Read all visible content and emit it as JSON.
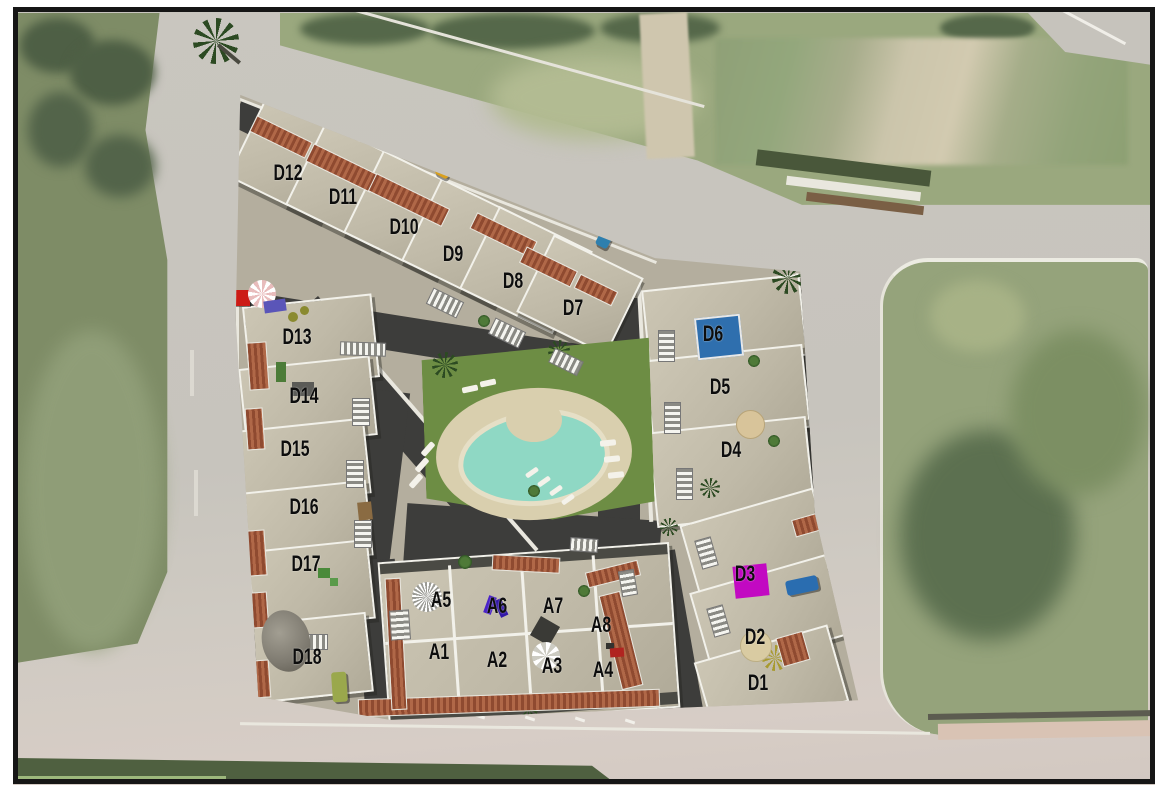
{
  "meta": {
    "title": "aerial-residential-site-plan"
  },
  "units": [
    {
      "id": "D1",
      "x": 758,
      "y": 683
    },
    {
      "id": "D2",
      "x": 755,
      "y": 637
    },
    {
      "id": "D3",
      "x": 745,
      "y": 574
    },
    {
      "id": "D4",
      "x": 731,
      "y": 450
    },
    {
      "id": "D5",
      "x": 720,
      "y": 387
    },
    {
      "id": "D6",
      "x": 713,
      "y": 334
    },
    {
      "id": "D7",
      "x": 573,
      "y": 308
    },
    {
      "id": "D8",
      "x": 513,
      "y": 281
    },
    {
      "id": "D9",
      "x": 453,
      "y": 254
    },
    {
      "id": "D10",
      "x": 404,
      "y": 227
    },
    {
      "id": "D11",
      "x": 343,
      "y": 197
    },
    {
      "id": "D12",
      "x": 288,
      "y": 173
    },
    {
      "id": "D13",
      "x": 297,
      "y": 337
    },
    {
      "id": "D14",
      "x": 304,
      "y": 396
    },
    {
      "id": "D15",
      "x": 295,
      "y": 449
    },
    {
      "id": "D16",
      "x": 304,
      "y": 507
    },
    {
      "id": "D17",
      "x": 306,
      "y": 564
    },
    {
      "id": "D18",
      "x": 307,
      "y": 657
    },
    {
      "id": "A1",
      "x": 439,
      "y": 652
    },
    {
      "id": "A2",
      "x": 497,
      "y": 660
    },
    {
      "id": "A3",
      "x": 552,
      "y": 666
    },
    {
      "id": "A4",
      "x": 603,
      "y": 670
    },
    {
      "id": "A5",
      "x": 441,
      "y": 600
    },
    {
      "id": "A6",
      "x": 497,
      "y": 606
    },
    {
      "id": "A7",
      "x": 553,
      "y": 606
    },
    {
      "id": "A8",
      "x": 601,
      "y": 625
    }
  ],
  "features": {
    "label_color": "#0d0d0d",
    "pool_color": "#8fd8c4",
    "lawn_color": "#6d8d44",
    "d6_pool_color": "#2f6fae",
    "d3_terrace_color": "#c209c2",
    "red_container_color": "#cc1b15",
    "vehicle_colors": {
      "yellow_car": "#d9a01e",
      "blue_car": "#2e7fae",
      "blue_truck": "#2a6db0",
      "green_van": "#9aa84c"
    }
  }
}
